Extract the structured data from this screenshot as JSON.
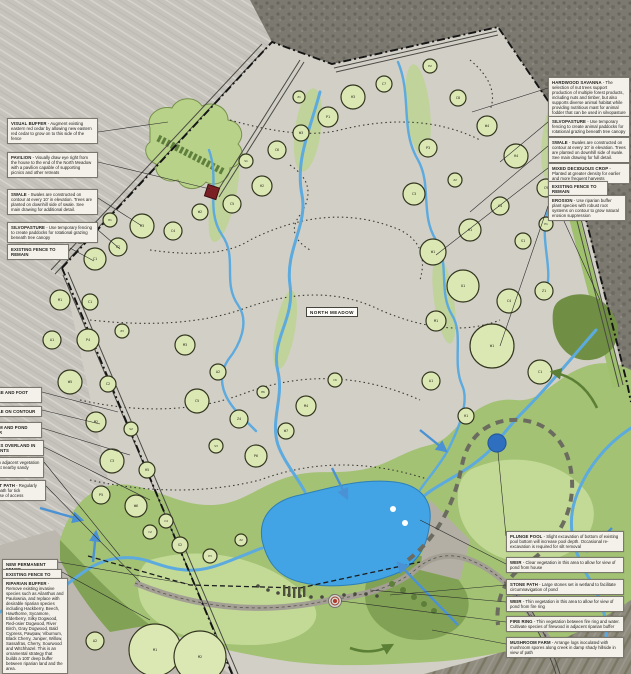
{
  "map": {
    "north_meadow_label": "NORTH MEADOW",
    "colors": {
      "pond_blue": "#42a4e4",
      "plunge_pool_blue": "#2f6fc0",
      "stream_blue": "#5caade",
      "meadow_gray": "#d2cfc7",
      "buffer_green_light": "#c3da97",
      "buffer_green": "#a3c274",
      "buffer_green_dark": "#81a254",
      "canopy_fill": "#dce8b4",
      "woods_gray": "#7b786f",
      "pavilion_red": "#7a1f24",
      "fence_black": "#141414"
    },
    "trees": [
      {
        "x": 95,
        "y": 259,
        "r": 11,
        "c": "C1"
      },
      {
        "x": 80,
        "y": 236,
        "r": 7,
        "c": "W1"
      },
      {
        "x": 118,
        "y": 247,
        "r": 9,
        "c": "C2"
      },
      {
        "x": 142,
        "y": 226,
        "r": 12,
        "c": "C3"
      },
      {
        "x": 110,
        "y": 220,
        "r": 7,
        "c": "H1"
      },
      {
        "x": 173,
        "y": 231,
        "r": 9,
        "c": "C4"
      },
      {
        "x": 200,
        "y": 212,
        "r": 8,
        "c": "W2"
      },
      {
        "x": 232,
        "y": 204,
        "r": 9,
        "c": "C5"
      },
      {
        "x": 262,
        "y": 186,
        "r": 10,
        "c": "H2"
      },
      {
        "x": 246,
        "y": 161,
        "r": 7,
        "c": "S1"
      },
      {
        "x": 277,
        "y": 150,
        "r": 9,
        "c": "C6"
      },
      {
        "x": 301,
        "y": 133,
        "r": 8,
        "c": "W3"
      },
      {
        "x": 328,
        "y": 117,
        "r": 10,
        "c": "P1"
      },
      {
        "x": 353,
        "y": 97,
        "r": 12,
        "c": "H3"
      },
      {
        "x": 384,
        "y": 84,
        "r": 8,
        "c": "C7"
      },
      {
        "x": 299,
        "y": 97,
        "r": 6,
        "c": "Z1"
      },
      {
        "x": 430,
        "y": 66,
        "r": 7,
        "c": "P2"
      },
      {
        "x": 458,
        "y": 98,
        "r": 8,
        "c": "C8"
      },
      {
        "x": 487,
        "y": 126,
        "r": 10,
        "c": "W4"
      },
      {
        "x": 516,
        "y": 156,
        "r": 12,
        "c": "H4"
      },
      {
        "x": 546,
        "y": 188,
        "r": 9,
        "c": "C9"
      },
      {
        "x": 428,
        "y": 148,
        "r": 9,
        "c": "P3"
      },
      {
        "x": 414,
        "y": 194,
        "r": 11,
        "c": "C3"
      },
      {
        "x": 455,
        "y": 180,
        "r": 7,
        "c": "Z2"
      },
      {
        "x": 60,
        "y": 300,
        "r": 10,
        "c": "M1"
      },
      {
        "x": 90,
        "y": 302,
        "r": 8,
        "c": "C1"
      },
      {
        "x": 52,
        "y": 340,
        "r": 9,
        "c": "A1"
      },
      {
        "x": 88,
        "y": 340,
        "r": 11,
        "c": "P4"
      },
      {
        "x": 122,
        "y": 331,
        "r": 7,
        "c": "Z3"
      },
      {
        "x": 70,
        "y": 382,
        "r": 12,
        "c": "W5"
      },
      {
        "x": 108,
        "y": 384,
        "r": 8,
        "c": "C2"
      },
      {
        "x": 96,
        "y": 422,
        "r": 10,
        "c": "M2"
      },
      {
        "x": 131,
        "y": 429,
        "r": 7,
        "c": "S2"
      },
      {
        "x": 112,
        "y": 461,
        "r": 12,
        "c": "C3"
      },
      {
        "x": 147,
        "y": 470,
        "r": 8,
        "c": "H5"
      },
      {
        "x": 101,
        "y": 495,
        "r": 9,
        "c": "P5"
      },
      {
        "x": 136,
        "y": 506,
        "r": 11,
        "c": "W6"
      },
      {
        "x": 166,
        "y": 521,
        "r": 7,
        "c": "C4"
      },
      {
        "x": 185,
        "y": 345,
        "r": 10,
        "c": "M3"
      },
      {
        "x": 218,
        "y": 372,
        "r": 8,
        "c": "A2"
      },
      {
        "x": 197,
        "y": 401,
        "r": 12,
        "c": "C5"
      },
      {
        "x": 239,
        "y": 419,
        "r": 9,
        "c": "Z4"
      },
      {
        "x": 216,
        "y": 446,
        "r": 7,
        "c": "S3"
      },
      {
        "x": 256,
        "y": 456,
        "r": 11,
        "c": "P6"
      },
      {
        "x": 286,
        "y": 431,
        "r": 8,
        "c": "W7"
      },
      {
        "x": 263,
        "y": 392,
        "r": 6,
        "c": "H6"
      },
      {
        "x": 306,
        "y": 406,
        "r": 10,
        "c": "M4"
      },
      {
        "x": 335,
        "y": 380,
        "r": 7,
        "c": "C6"
      },
      {
        "x": 433,
        "y": 252,
        "r": 13,
        "c": "W1"
      },
      {
        "x": 470,
        "y": 230,
        "r": 11,
        "c": "H1"
      },
      {
        "x": 500,
        "y": 206,
        "r": 9,
        "c": "C4"
      },
      {
        "x": 523,
        "y": 241,
        "r": 8,
        "c": "S1"
      },
      {
        "x": 546,
        "y": 224,
        "r": 7,
        "c": "P1"
      },
      {
        "x": 463,
        "y": 286,
        "r": 16,
        "c": "O1"
      },
      {
        "x": 509,
        "y": 301,
        "r": 12,
        "c": "C4"
      },
      {
        "x": 544,
        "y": 291,
        "r": 9,
        "c": "Z1"
      },
      {
        "x": 436,
        "y": 321,
        "r": 10,
        "c": "M1"
      },
      {
        "x": 492,
        "y": 346,
        "r": 22,
        "c": "W1"
      },
      {
        "x": 540,
        "y": 372,
        "r": 12,
        "c": "C1"
      },
      {
        "x": 431,
        "y": 381,
        "r": 9,
        "c": "A1"
      },
      {
        "x": 466,
        "y": 416,
        "r": 8,
        "c": "H1"
      },
      {
        "x": 180,
        "y": 545,
        "r": 8,
        "c": "S2"
      },
      {
        "x": 210,
        "y": 556,
        "r": 7,
        "c": "P3"
      },
      {
        "x": 241,
        "y": 540,
        "r": 6,
        "c": "Z2"
      },
      {
        "x": 150,
        "y": 532,
        "r": 7,
        "c": "C2"
      },
      {
        "x": 155,
        "y": 650,
        "r": 26,
        "c": "M1"
      },
      {
        "x": 200,
        "y": 657,
        "r": 26,
        "c": "M2"
      },
      {
        "x": 95,
        "y": 641,
        "r": 9,
        "c": "A2"
      }
    ]
  },
  "callouts": {
    "top_left": [
      {
        "x": 7,
        "y": 118,
        "w": 91,
        "title": "VISUAL BUFFER",
        "body": "Augment existing eastern red cedar by allowing new eastern red cedar to grow on to this side of the fence"
      },
      {
        "x": 7,
        "y": 152,
        "w": 91,
        "title": "PAVILION",
        "body": "Visually draw eye right from the house to the end of the North Meadow with a pavilion capable of supporting picnics and other retreats"
      },
      {
        "x": 7,
        "y": 189,
        "w": 91,
        "title": "SWALE",
        "body": "Swales are constructed on contour at every 10' in elevation. Trees are planted on downhill side of swale. See main drawing for additional detail."
      },
      {
        "x": 7,
        "y": 222,
        "w": 91,
        "title": "SILVOPASTURE",
        "body": "Use temporary fencing to create paddocks for rotational grazing beneath tree canopy"
      },
      {
        "x": 7,
        "y": 244,
        "w": 62,
        "title": "EXISTING FENCE TO REMAIN",
        "body": ""
      }
    ],
    "top_right": [
      {
        "x": 548,
        "y": 77,
        "w": 82,
        "title": "HARDWOOD SAVANNA",
        "body": "The selection of nut trees support production of multiple forest products, including nuts and timber, but also supports diverse animal habitat while providing nutritious mast for animal fodder that can be used in silvopasture operations"
      },
      {
        "x": 548,
        "y": 116,
        "w": 82,
        "title": "SILVOPASTURE",
        "body": "Use temporary fencing to create animal paddocks for rotational grazing beneath tree canopy"
      },
      {
        "x": 548,
        "y": 137,
        "w": 82,
        "title": "SWALE",
        "body": "Swales are constructed on contour at every 10' in elevation. Trees are planted on downhill side of swale. See main drawing for full detail."
      },
      {
        "x": 548,
        "y": 163,
        "w": 82,
        "title": "MIXED DECIDUOUS CROP",
        "body": "Planted at greater density for earlier and more frequent harvests"
      },
      {
        "x": 548,
        "y": 181,
        "w": 60,
        "title": "EXISTING FENCE TO REMAIN",
        "body": ""
      },
      {
        "x": 548,
        "y": 195,
        "w": 78,
        "title": "EROSION",
        "body": "Use riparian buffer plant species with robust root systems on contour to grow natural erosion suppression"
      }
    ],
    "mid_left": [
      {
        "x": -16,
        "y": 387,
        "w": 58,
        "title": "HORSE AND FOOT PATH",
        "body": ""
      },
      {
        "x": -16,
        "y": 406,
        "w": 58,
        "title": "SWALE ON CONTOUR",
        "body": ""
      },
      {
        "x": -20,
        "y": 422,
        "w": 62,
        "title": "STREAM AND POND BUFFER",
        "body": ""
      },
      {
        "x": -30,
        "y": 440,
        "w": 74,
        "title": "CREEK RUNS OVERLAND IN STORM EVENTS",
        "body": ""
      },
      {
        "x": -42,
        "y": 457,
        "w": 86,
        "title": "WATERFALL",
        "body": "Thin adjacent vegetation to facilitate picnics at nearby sandy shore area"
      },
      {
        "x": -42,
        "y": 480,
        "w": 88,
        "title": "HORSE AND FOOT PATH",
        "body": "Regularly mow and maintain path for tick suppression and ease of access"
      }
    ],
    "bottom_left": [
      {
        "x": 2,
        "y": 559,
        "w": 56,
        "title": "NEW PERMANENT FENCE",
        "body": ""
      },
      {
        "x": 2,
        "y": 569,
        "w": 60,
        "title": "EXISTING FENCE TO REMAIN",
        "body": ""
      },
      {
        "x": 2,
        "y": 578,
        "w": 66,
        "title": "RIPARIAN BUFFER",
        "body": "Remove existing invasive species such as Ailanthus and Paulownia, and replace with desirable riparian species including Hackberry, Beech, Hawthorne, Sycamore, Elderberry, Silky Dogwood, Red-osier Dogwood, River Birch, Gray Dogwood, Bald Cypress, Pawpaw, Viburnum, Black Cherry, Juniper, Willow, Sassafras, Cherry, Sourwood and Witchhazel. This is an ornamental strategy that builds a 100' deep buffer between riparian land and the area."
      }
    ],
    "bottom_right": [
      {
        "x": 506,
        "y": 531,
        "w": 118,
        "title": "PLUNGE POOL",
        "body": "Slight excavation of bottom of existing pool bottom will increase pool depth. Occasional re-excavation is required for silt removal"
      },
      {
        "x": 506,
        "y": 557,
        "w": 118,
        "title": "WEIR",
        "body": "Clear vegetation in this area to allow for view of pond from house"
      },
      {
        "x": 506,
        "y": 579,
        "w": 118,
        "title": "STONE PATH",
        "body": "Large stones set in wetland to facilitate circumnavigation of pond"
      },
      {
        "x": 506,
        "y": 596,
        "w": 118,
        "title": "WEIR",
        "body": "Thin vegetation in this area to allow for view of pond from fire ring"
      },
      {
        "x": 506,
        "y": 616,
        "w": 118,
        "title": "FIRE RING",
        "body": "Thin vegetation between fire ring and water. Cultivate species of firewood in adjacent riparian buffer"
      },
      {
        "x": 506,
        "y": 637,
        "w": 118,
        "title": "MUSHROOM FARM",
        "body": "Arrange logs inoculated with mushroom spores along creek in damp shady hillside in view of path"
      }
    ]
  }
}
